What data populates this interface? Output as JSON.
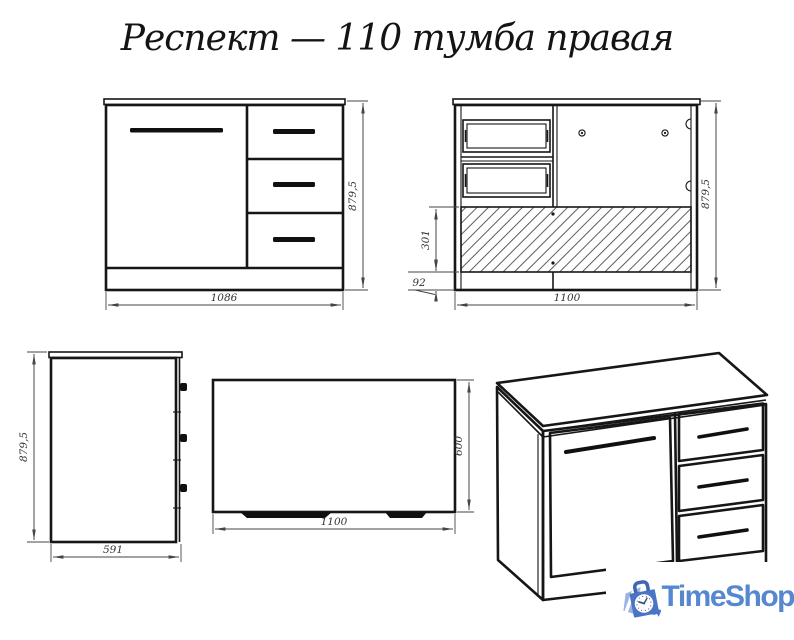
{
  "title": "Респект — 110 тумба правая",
  "dimensions": {
    "front": {
      "width": "1086",
      "height": "879,5"
    },
    "rear": {
      "width": "1100",
      "height": "879,5",
      "drawer_zone_height": "301",
      "plinth_height": "92"
    },
    "side": {
      "height": "879,5",
      "depth": "591"
    },
    "top": {
      "width": "1100",
      "depth": "600"
    }
  },
  "logo": {
    "text": "TimeShop"
  },
  "colors": {
    "outline": "#161616",
    "dimension": "#454545",
    "logo_text_blue": "#5688d0",
    "logo_bag_blue": "#4a74c4",
    "logo_bag_light": "#9db4e0"
  }
}
